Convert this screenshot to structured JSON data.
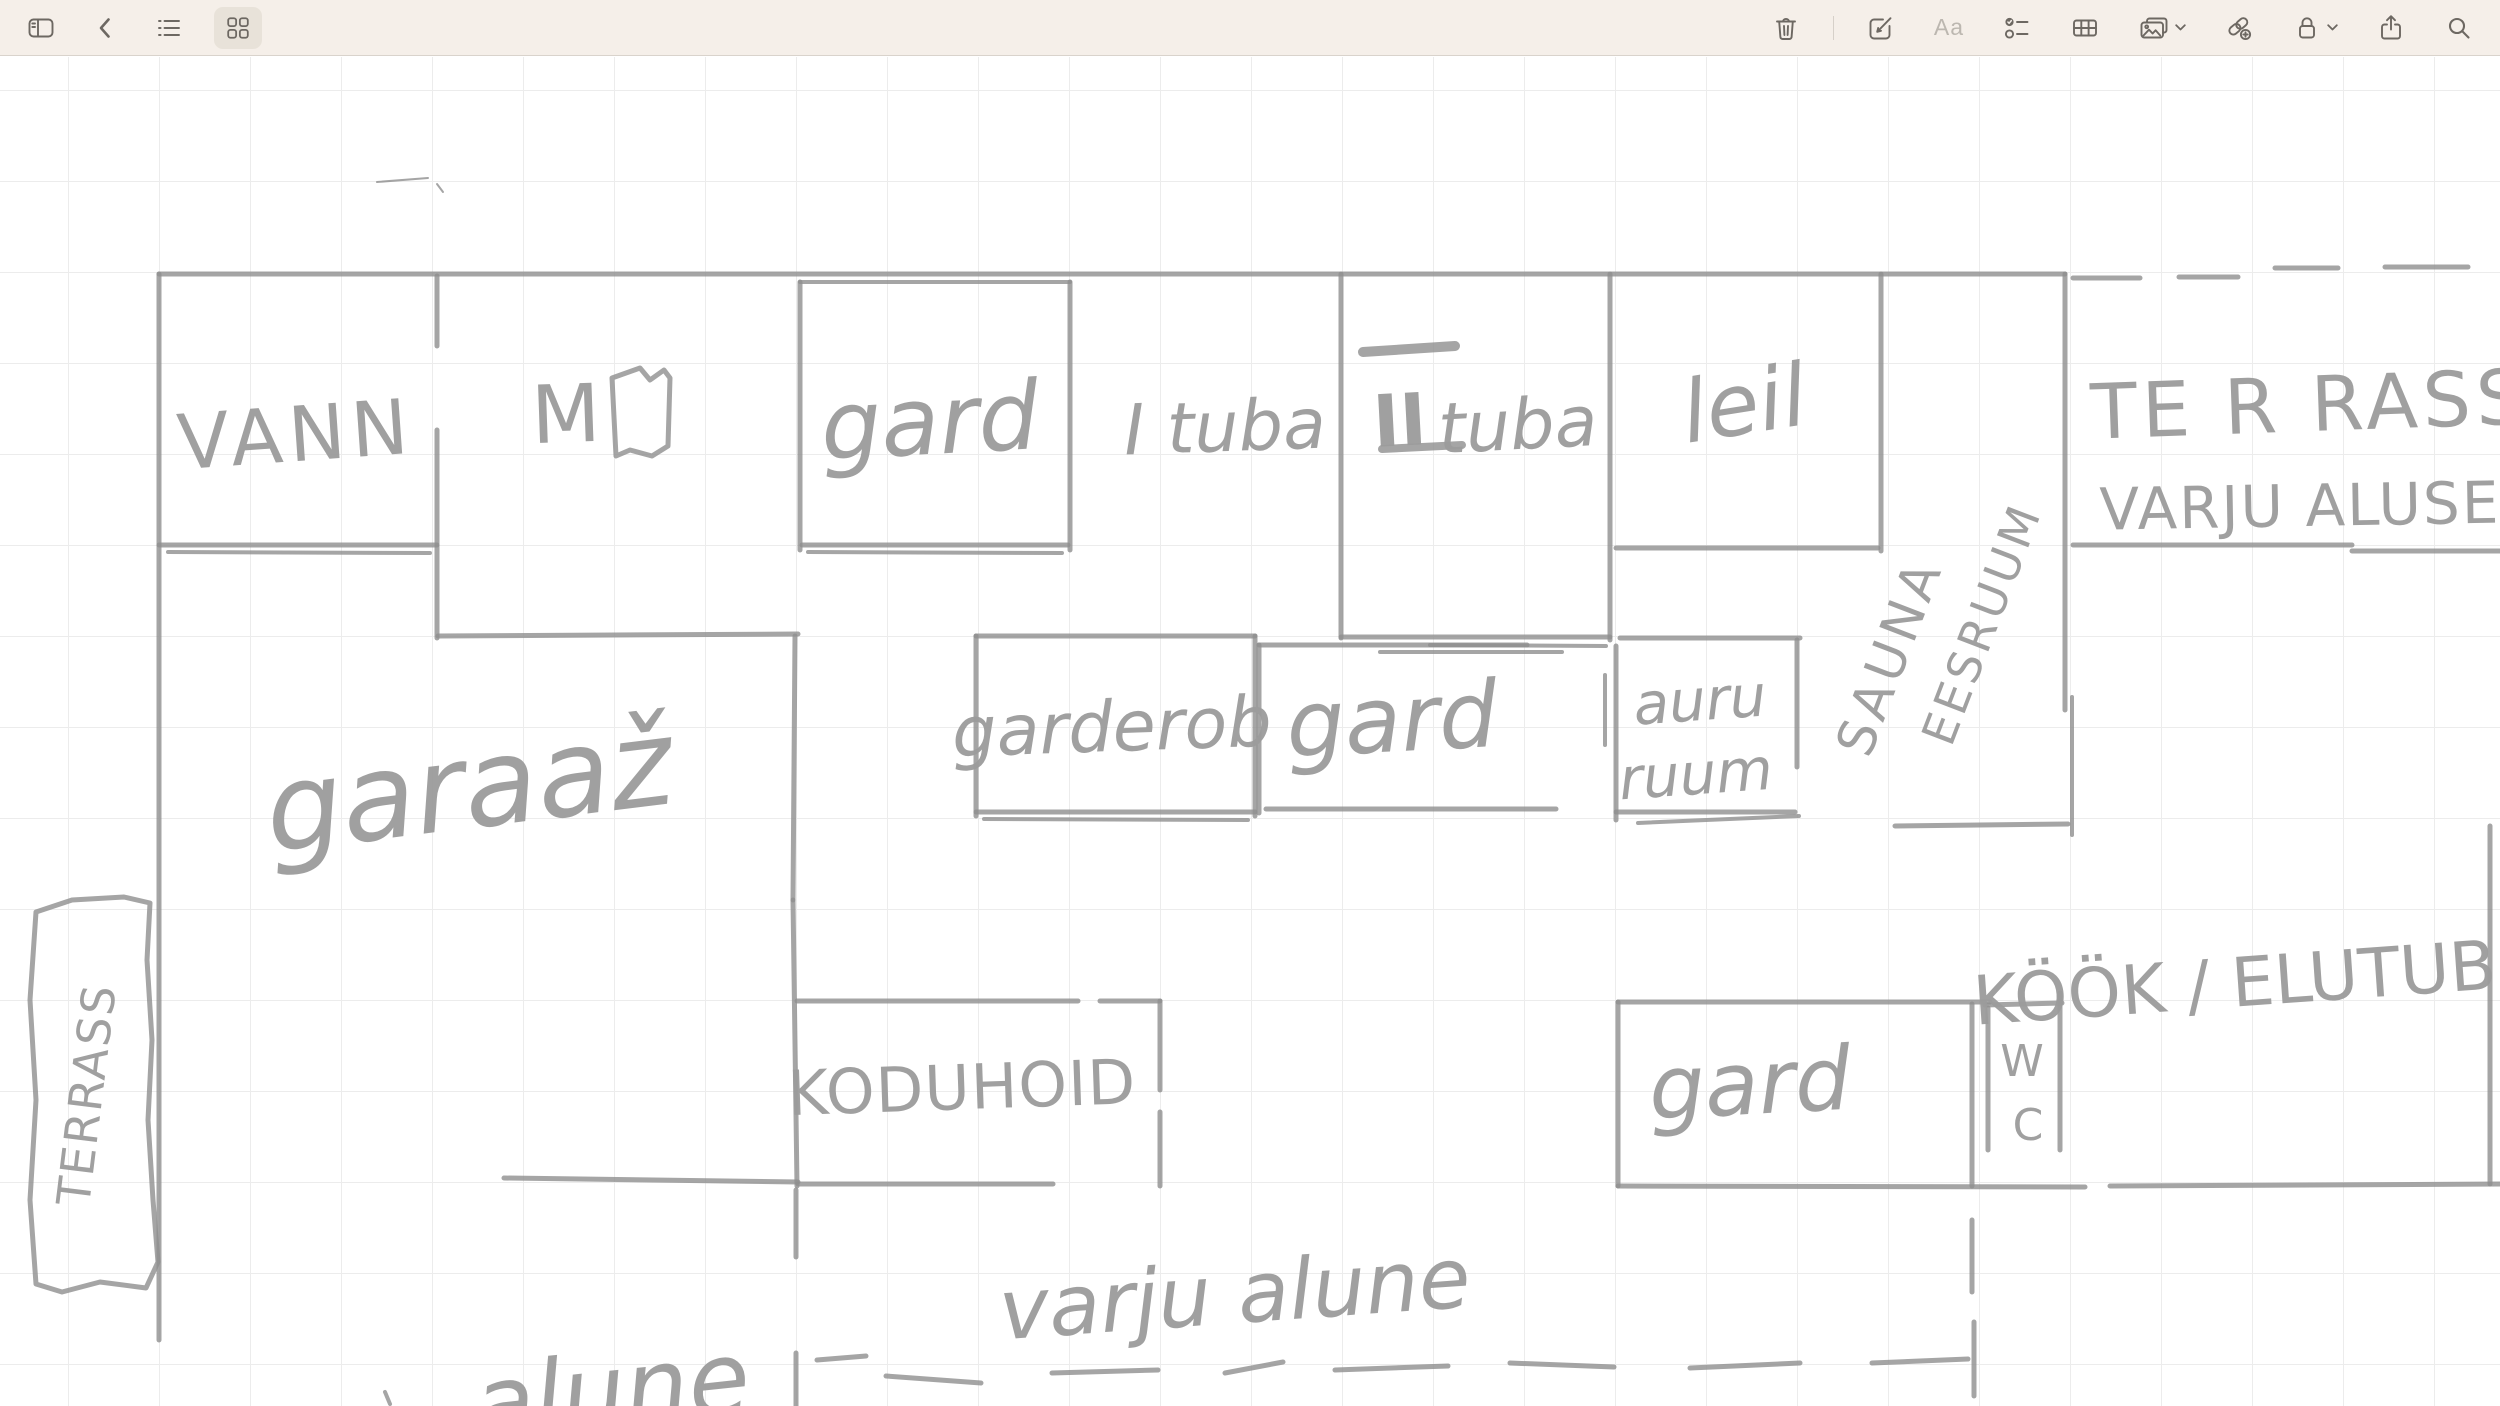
{
  "toolbar": {
    "bg_color": "#f5efe9",
    "border_color": "#d9d3cc",
    "icon_color": "#6d6862",
    "disabled_icon_color": "#bcb7b0",
    "active_item_bg": "#e8e2d9",
    "left_items": [
      {
        "id": "toggle-sidebar",
        "icon": "sidebar-icon"
      },
      {
        "id": "back",
        "icon": "chevron-left-icon"
      },
      {
        "id": "view-list",
        "icon": "list-icon"
      },
      {
        "id": "view-gallery",
        "icon": "gallery-icon",
        "active": true
      }
    ],
    "right_items": [
      {
        "id": "delete-note",
        "icon": "trash-icon"
      },
      {
        "id": "new-note",
        "icon": "compose-icon"
      },
      {
        "id": "text-format",
        "icon": "format-icon",
        "label": "Aa",
        "disabled": true
      },
      {
        "id": "checklist",
        "icon": "checklist-icon"
      },
      {
        "id": "insert-table",
        "icon": "table-icon"
      },
      {
        "id": "insert-media",
        "icon": "media-icon",
        "has_chevron": true
      },
      {
        "id": "add-link",
        "icon": "add-link-icon"
      },
      {
        "id": "lock-note",
        "icon": "lock-icon",
        "has_chevron": true
      },
      {
        "id": "share-note",
        "icon": "share-icon"
      },
      {
        "id": "search",
        "icon": "search-icon"
      }
    ]
  },
  "canvas": {
    "bg": "#ffffff",
    "grid_color": "#ececec",
    "grid_size": 91,
    "ink": "#8f8f8f",
    "ink_opacity": 0.8,
    "text_ink": "#9b9b9b"
  },
  "sketch": {
    "kind": "hand-drawn floor plan",
    "room_names": [
      "VANN",
      "M",
      "gard",
      "I tuba",
      "II tuba",
      "leil",
      "SAUNA EESRUUM",
      "TERRASS VARJU ALUSE",
      "garderob",
      "gard",
      "auru ruum",
      "garaaž",
      "TERRASS",
      "KODUHOID",
      "gard",
      "WC",
      "KÖÖK / ELUTUB",
      "varju alune",
      "alune"
    ],
    "walls": [
      [
        159,
        274,
        2065,
        274
      ],
      [
        800,
        282,
        1070,
        282,
        4
      ],
      [
        159,
        274,
        159,
        1340
      ],
      [
        159,
        545,
        437,
        545
      ],
      [
        168,
        552,
        430,
        553,
        4
      ],
      [
        437,
        276,
        437,
        346
      ],
      [
        437,
        430,
        437,
        638
      ],
      [
        438,
        636,
        798,
        634
      ],
      [
        800,
        282,
        800,
        550
      ],
      [
        1070,
        282,
        1070,
        550
      ],
      [
        802,
        545,
        1068,
        545
      ],
      [
        808,
        552,
        1062,
        553,
        4
      ],
      [
        1341,
        274,
        1341,
        638
      ],
      [
        1341,
        637,
        1610,
        637
      ],
      [
        1430,
        645,
        1606,
        646,
        4
      ],
      [
        1610,
        274,
        1610,
        640
      ],
      [
        1616,
        548,
        1878,
        548
      ],
      [
        1881,
        274,
        1881,
        551
      ],
      [
        2065,
        274,
        2065,
        710
      ],
      [
        2072,
        697,
        2072,
        835,
        4
      ],
      [
        1895,
        826,
        2068,
        824
      ],
      [
        2073,
        545,
        2352,
        545
      ],
      [
        2352,
        551,
        2500,
        551
      ],
      [
        2073,
        278,
        2140,
        278
      ],
      [
        2179,
        277,
        2238,
        277
      ],
      [
        2275,
        268,
        2338,
        268
      ],
      [
        2385,
        267,
        2468,
        267
      ],
      [
        976,
        636,
        1255,
        636
      ],
      [
        976,
        636,
        976,
        816
      ],
      [
        1255,
        636,
        1255,
        816
      ],
      [
        976,
        812,
        1255,
        812
      ],
      [
        984,
        819,
        1248,
        820,
        4
      ],
      [
        1259,
        645,
        1527,
        645
      ],
      [
        1380,
        652,
        1562,
        652,
        4
      ],
      [
        1259,
        645,
        1259,
        813
      ],
      [
        1266,
        809,
        1556,
        809
      ],
      [
        1605,
        675,
        1605,
        745,
        4
      ],
      [
        1620,
        638,
        1800,
        638
      ],
      [
        1616,
        646,
        1616,
        820
      ],
      [
        1797,
        640,
        1797,
        767
      ],
      [
        1616,
        812,
        1795,
        812
      ],
      [
        1638,
        823,
        1799,
        816,
        4
      ],
      [
        795,
        636,
        793,
        900
      ],
      [
        793,
        900,
        797,
        1186
      ],
      [
        797,
        1001,
        1078,
        1001
      ],
      [
        1100,
        1001,
        1160,
        1001
      ],
      [
        1160,
        1001,
        1160,
        1090
      ],
      [
        1160,
        1112,
        1160,
        1186
      ],
      [
        504,
        1178,
        798,
        1182
      ],
      [
        798,
        1184,
        1053,
        1184
      ],
      [
        1618,
        1186,
        2085,
        1187
      ],
      [
        2110,
        1186,
        2500,
        1184
      ],
      [
        796,
        1190,
        796,
        1257
      ],
      [
        796,
        1353,
        796,
        1406
      ],
      [
        1618,
        1002,
        1990,
        1002
      ],
      [
        1985,
        1005,
        2062,
        1003
      ],
      [
        1618,
        1002,
        1618,
        1186
      ],
      [
        1972,
        1004,
        1972,
        1186
      ],
      [
        1988,
        1008,
        1988,
        1150
      ],
      [
        2060,
        993,
        2060,
        1150
      ],
      [
        2490,
        826,
        2490,
        1184
      ],
      [
        1972,
        1220,
        1972,
        1292
      ],
      [
        1974,
        1322,
        1974,
        1396
      ],
      [
        817,
        1360,
        866,
        1356
      ],
      [
        886,
        1376,
        981,
        1383
      ],
      [
        1052,
        1373,
        1158,
        1370
      ],
      [
        1225,
        1373,
        1283,
        1362
      ],
      [
        1335,
        1370,
        1448,
        1366
      ],
      [
        1510,
        1363,
        1614,
        1367
      ],
      [
        1690,
        1368,
        1800,
        1363
      ],
      [
        1872,
        1363,
        1968,
        1359
      ],
      [
        1363,
        352,
        1455,
        346,
        10
      ],
      [
        1382,
        449,
        1462,
        445,
        8
      ],
      [
        377,
        182,
        428,
        178,
        2
      ],
      [
        437,
        184,
        443,
        192,
        2
      ],
      [
        385,
        1392,
        390,
        1404,
        4
      ]
    ],
    "polylines": [
      {
        "id": "terrace-outline",
        "pts": "36,912 72,900 124,897 150,903 147,960 152,1040 148,1120 153,1200 158,1262 146,1288 100,1282 62,1292 36,1284 30,1200 36,1100 30,1000 36,912",
        "w": 5
      },
      {
        "id": "m-room-glyph",
        "pts": "612,378 640,368 650,380 664,370 670,378 668,446 652,456 630,450 616,456 612,378",
        "w": 5
      }
    ],
    "labels": [
      {
        "id": "vann",
        "t": "VANN",
        "x": 296,
        "y": 440,
        "s": 76,
        "r": -4,
        "st": "print",
        "ls": 6
      },
      {
        "id": "m",
        "t": "M",
        "x": 566,
        "y": 420,
        "s": 80,
        "r": -2,
        "st": "print"
      },
      {
        "id": "gard-top",
        "t": "gard",
        "x": 930,
        "y": 428,
        "s": 95,
        "r": -3,
        "st": "script"
      },
      {
        "id": "tuba-1",
        "t": "I tuba",
        "x": 1225,
        "y": 432,
        "s": 70,
        "r": -2,
        "st": "script"
      },
      {
        "id": "tuba-2-num",
        "t": "II",
        "x": 1400,
        "y": 426,
        "s": 72,
        "r": -3,
        "st": "print",
        "fw": "bold",
        "c": "#8a8a8a"
      },
      {
        "id": "tuba-2",
        "t": "tuba",
        "x": 1518,
        "y": 430,
        "s": 70,
        "r": -3,
        "st": "script"
      },
      {
        "id": "leil",
        "t": "leil",
        "x": 1745,
        "y": 410,
        "s": 86,
        "r": -9,
        "st": "script"
      },
      {
        "id": "sauna-line-1",
        "t": "SAUNA",
        "x": 1893,
        "y": 658,
        "s": 52,
        "r": -69,
        "st": "print",
        "ls": 5
      },
      {
        "id": "sauna-line-2",
        "t": "EESRUUM",
        "x": 1985,
        "y": 625,
        "s": 46,
        "r": -69,
        "st": "print",
        "ls": 4
      },
      {
        "id": "terrass-right",
        "t": "TE R RASS",
        "x": 2310,
        "y": 410,
        "s": 76,
        "r": -2,
        "st": "print",
        "ls": 5
      },
      {
        "id": "varju-aluse",
        "t": "VARJU ALUSE",
        "x": 2300,
        "y": 510,
        "s": 58,
        "r": -1,
        "st": "print",
        "ls": 2
      },
      {
        "id": "garderob",
        "t": "garderob",
        "x": 1112,
        "y": 732,
        "s": 70,
        "r": -2,
        "st": "script"
      },
      {
        "id": "gard-mid",
        "t": "gard",
        "x": 1392,
        "y": 726,
        "s": 92,
        "r": -3,
        "st": "script"
      },
      {
        "id": "auru-1",
        "t": "auru",
        "x": 1700,
        "y": 704,
        "s": 58,
        "r": -4,
        "st": "script"
      },
      {
        "id": "auru-2",
        "t": "ruum",
        "x": 1696,
        "y": 778,
        "s": 58,
        "r": -4,
        "st": "script"
      },
      {
        "id": "garaaz",
        "t": "garaaž",
        "x": 470,
        "y": 795,
        "s": 120,
        "r": -7,
        "st": "script"
      },
      {
        "id": "terrass-left",
        "t": "TERRASS",
        "x": 90,
        "y": 1095,
        "s": 46,
        "r": -83,
        "st": "print",
        "ls": 2
      },
      {
        "id": "koduhoid",
        "t": "KODUHOID",
        "x": 962,
        "y": 1092,
        "s": 62,
        "r": -2,
        "st": "print",
        "ls": 1
      },
      {
        "id": "gard-bottom",
        "t": "gard",
        "x": 1750,
        "y": 1090,
        "s": 88,
        "r": -3,
        "st": "script"
      },
      {
        "id": "wc-w",
        "t": "W",
        "x": 2022,
        "y": 1064,
        "s": 44,
        "r": 0,
        "st": "print"
      },
      {
        "id": "wc-c",
        "t": "C",
        "x": 2028,
        "y": 1128,
        "s": 44,
        "r": 0,
        "st": "print"
      },
      {
        "id": "kook-elutuba",
        "t": "KÖÖK / ELUTUB",
        "x": 2235,
        "y": 988,
        "s": 68,
        "r": -4,
        "st": "print"
      },
      {
        "id": "varju-alune",
        "t": "varju alune",
        "x": 1235,
        "y": 1300,
        "s": 84,
        "r": -4,
        "st": "script"
      },
      {
        "id": "alune-partial",
        "t": "alune",
        "x": 612,
        "y": 1398,
        "s": 100,
        "r": -6,
        "st": "script"
      }
    ]
  }
}
